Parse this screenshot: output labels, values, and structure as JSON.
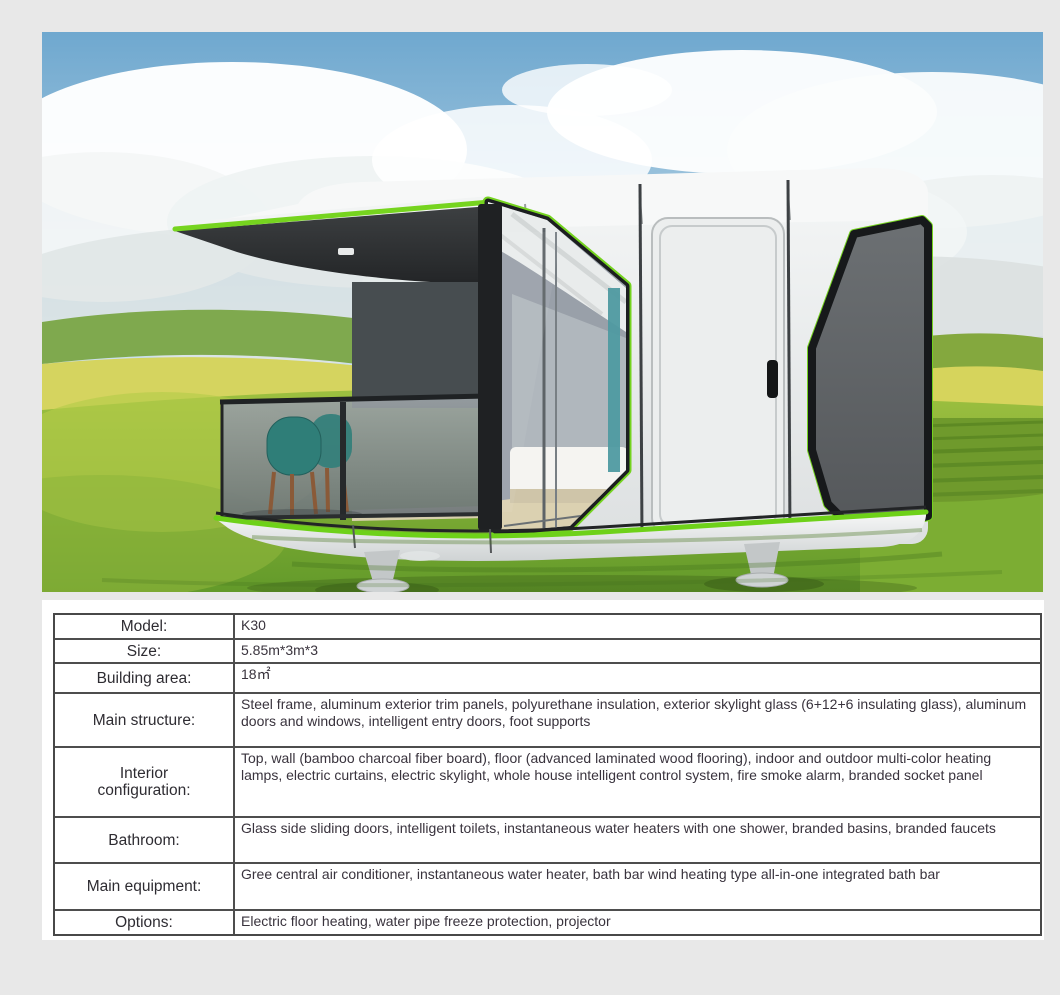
{
  "page": {
    "background_color": "#e8e8e8"
  },
  "product_photo": {
    "alt": "Rendering of a white capsule tiny house with lime-green trim, large glazed bedroom window, entry door and dark panoramic end window, standing on foot supports in a grassy field under a cloudy blue sky",
    "colors": {
      "trim_green": "#74d31e",
      "house_white": "#eff1f1",
      "frame_black": "#1c1e20",
      "window_gray": "#5f6366",
      "sky_blue": "#79afd2",
      "grass_green": "#7fb33a",
      "field_yellow": "#d6d45c",
      "chair_teal": "#2f7e78"
    }
  },
  "spec_table": {
    "rows": [
      {
        "label": "Model:",
        "value": "K30"
      },
      {
        "label": "Size:",
        "value": "5.85m*3m*3"
      },
      {
        "label": "Building area:",
        "value": "18㎡"
      },
      {
        "label": "Main structure:",
        "value": "Steel frame, aluminum exterior trim panels, polyurethane insulation, exterior skylight glass (6+12+6 insulating glass), aluminum doors and windows, intelligent entry doors, foot supports"
      },
      {
        "label": "Interior\nconfiguration:",
        "value": "Top, wall (bamboo charcoal fiber board), floor (advanced laminated wood flooring), indoor and outdoor multi-color heating lamps, electric curtains, electric skylight, whole house intelligent control system, fire smoke alarm, branded socket panel"
      },
      {
        "label": "Bathroom:",
        "value": "Glass side sliding doors, intelligent toilets, instantaneous water heaters with one shower, branded basins, branded faucets"
      },
      {
        "label": "Main equipment:",
        "value": "Gree central air conditioner, instantaneous water heater, bath bar wind heating type all-in-one integrated bath bar"
      },
      {
        "label": "Options:",
        "value": "Electric floor heating, water pipe freeze protection, projector"
      }
    ]
  }
}
